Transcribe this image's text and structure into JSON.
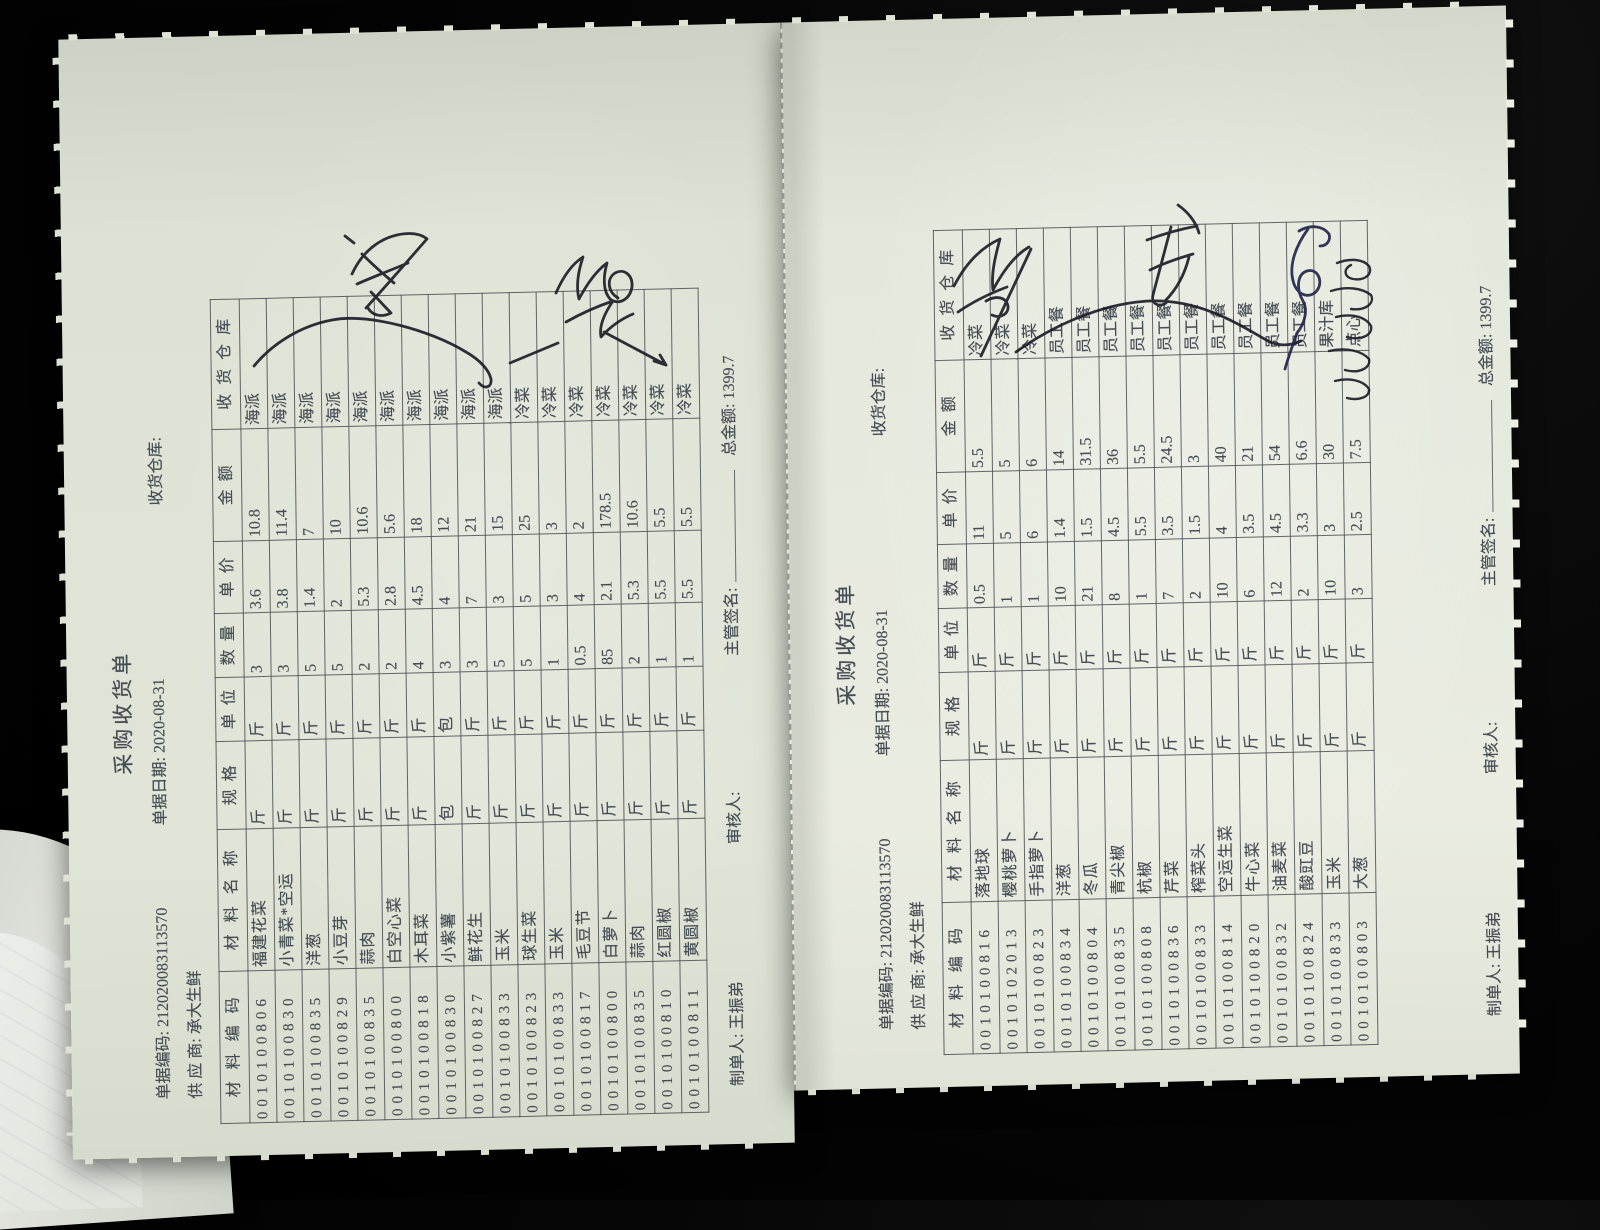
{
  "photo": {
    "background_color": "#000000",
    "paper_color": "#e0e5d8",
    "ink_print_color": "#454c53",
    "handwriting_color": "#1a1b24"
  },
  "documents": [
    {
      "title": "采购收货单",
      "doc_no_label": "单据编码:",
      "doc_no": "212020083113570",
      "date_label": "单据日期:",
      "date": "2020-08-31",
      "warehouse_label": "收货仓库:",
      "warehouse_value": "",
      "supplier_label": "供 应 商:",
      "supplier": "承大生鲜",
      "columns": [
        "材料编码",
        "材料名称",
        "规格",
        "单位",
        "数量",
        "单价",
        "金额",
        "收货仓库"
      ],
      "rows": [
        [
          "0010100806",
          "福建花菜",
          "斤",
          "斤",
          "3",
          "3.6",
          "10.8",
          "海派"
        ],
        [
          "0010100830",
          "小青菜*空运",
          "斤",
          "斤",
          "3",
          "3.8",
          "11.4",
          "海派"
        ],
        [
          "0010100835",
          "洋葱",
          "斤",
          "斤",
          "5",
          "1.4",
          "7",
          "海派"
        ],
        [
          "0010100829",
          "小豆芽",
          "斤",
          "斤",
          "5",
          "2",
          "10",
          "海派"
        ],
        [
          "0010100835",
          "蒜肉",
          "斤",
          "斤",
          "2",
          "5.3",
          "10.6",
          "海派"
        ],
        [
          "0010100800",
          "白空心菜",
          "斤",
          "斤",
          "2",
          "2.8",
          "5.6",
          "海派"
        ],
        [
          "0010100818",
          "木耳菜",
          "斤",
          "斤",
          "4",
          "4.5",
          "18",
          "海派"
        ],
        [
          "0010100830",
          "小紫薯",
          "包",
          "包",
          "3",
          "4",
          "12",
          "海派"
        ],
        [
          "0010100827",
          "鲜花生",
          "斤",
          "斤",
          "3",
          "7",
          "21",
          "海派"
        ],
        [
          "0010100833",
          "玉米",
          "斤",
          "斤",
          "5",
          "3",
          "15",
          "海派"
        ],
        [
          "0010100823",
          "球生菜",
          "斤",
          "斤",
          "5",
          "5",
          "25",
          "冷菜"
        ],
        [
          "0010100833",
          "玉米",
          "斤",
          "斤",
          "1",
          "3",
          "3",
          "冷菜"
        ],
        [
          "0010100817",
          "毛豆节",
          "斤",
          "斤",
          "0.5",
          "4",
          "2",
          "冷菜"
        ],
        [
          "0010100800",
          "白萝卜",
          "斤",
          "斤",
          "85",
          "2.1",
          "178.5",
          "冷菜"
        ],
        [
          "0010100835",
          "蒜肉",
          "斤",
          "斤",
          "2",
          "5.3",
          "10.6",
          "冷菜"
        ],
        [
          "0010100810",
          "红圆椒",
          "斤",
          "斤",
          "1",
          "5.5",
          "5.5",
          "冷菜"
        ],
        [
          "0010100811",
          "黄圆椒",
          "斤",
          "斤",
          "1",
          "5.5",
          "5.5",
          "冷菜"
        ]
      ],
      "footer": {
        "maker_label": "制单人:",
        "maker": "王振弟",
        "auditor_label": "审核人:",
        "auditor": "",
        "sign_label": "主管签名:",
        "total_label": "总金额:",
        "total": "1399.7"
      }
    },
    {
      "title": "采购收货单",
      "doc_no_label": "单据编码:",
      "doc_no": "212020083113570",
      "date_label": "单据日期:",
      "date": "2020-08-31",
      "warehouse_label": "收货仓库:",
      "warehouse_value": "",
      "supplier_label": "供 应 商:",
      "supplier": "承大生鲜",
      "columns": [
        "材料编码",
        "材料名称",
        "规格",
        "单位",
        "数量",
        "单价",
        "金额",
        "收货仓库"
      ],
      "rows": [
        [
          "0010100816",
          "落地球",
          "斤",
          "斤",
          "0.5",
          "11",
          "5.5",
          "冷菜"
        ],
        [
          "0010102013",
          "樱桃萝卜",
          "斤",
          "斤",
          "1",
          "5",
          "5",
          "冷菜"
        ],
        [
          "0010100823",
          "手指萝卜",
          "斤",
          "斤",
          "1",
          "6",
          "6",
          "冷菜"
        ],
        [
          "0010100834",
          "洋葱",
          "斤",
          "斤",
          "10",
          "1.4",
          "14",
          "员工餐"
        ],
        [
          "0010100804",
          "冬瓜",
          "斤",
          "斤",
          "21",
          "1.5",
          "31.5",
          "员工餐"
        ],
        [
          "0010100835",
          "青尖椒",
          "斤",
          "斤",
          "8",
          "4.5",
          "36",
          "员工餐"
        ],
        [
          "0010100808",
          "杭椒",
          "斤",
          "斤",
          "1",
          "5.5",
          "5.5",
          "员工餐"
        ],
        [
          "0010100836",
          "芹菜",
          "斤",
          "斤",
          "7",
          "3.5",
          "24.5",
          "员工餐"
        ],
        [
          "0010100833",
          "榨菜头",
          "斤",
          "斤",
          "2",
          "1.5",
          "3",
          "员工餐"
        ],
        [
          "0010100814",
          "空运生菜",
          "斤",
          "斤",
          "10",
          "4",
          "40",
          "员工餐"
        ],
        [
          "0010100820",
          "牛心菜",
          "斤",
          "斤",
          "6",
          "3.5",
          "21",
          "员工餐"
        ],
        [
          "0010100832",
          "油麦菜",
          "斤",
          "斤",
          "12",
          "4.5",
          "54",
          "员工餐"
        ],
        [
          "0010100824",
          "酸豇豆",
          "斤",
          "斤",
          "2",
          "3.3",
          "6.6",
          "员工餐"
        ],
        [
          "0010100833",
          "玉米",
          "斤",
          "斤",
          "10",
          "3",
          "30",
          "果汁库"
        ],
        [
          "0010100803",
          "大葱",
          "斤",
          "斤",
          "3",
          "2.5",
          "7.5",
          "点心"
        ]
      ],
      "footer": {
        "maker_label": "制单人:",
        "maker": "王振弟",
        "auditor_label": "审核人:",
        "auditor": "",
        "sign_label": "主管签名:",
        "total_label": "总金额:",
        "total": "1399.7"
      }
    }
  ],
  "annotations": {
    "left_page": [
      "approval-scribble",
      "approval-scribble",
      "check-curve-over-warehouse-column",
      "tick-line",
      "arrow-line"
    ],
    "right_page": [
      "approval-scribble",
      "check-curve-over-warehouse-column",
      "handwritten-character-mark",
      "signature-scribble",
      "handwritten-name-column"
    ]
  }
}
